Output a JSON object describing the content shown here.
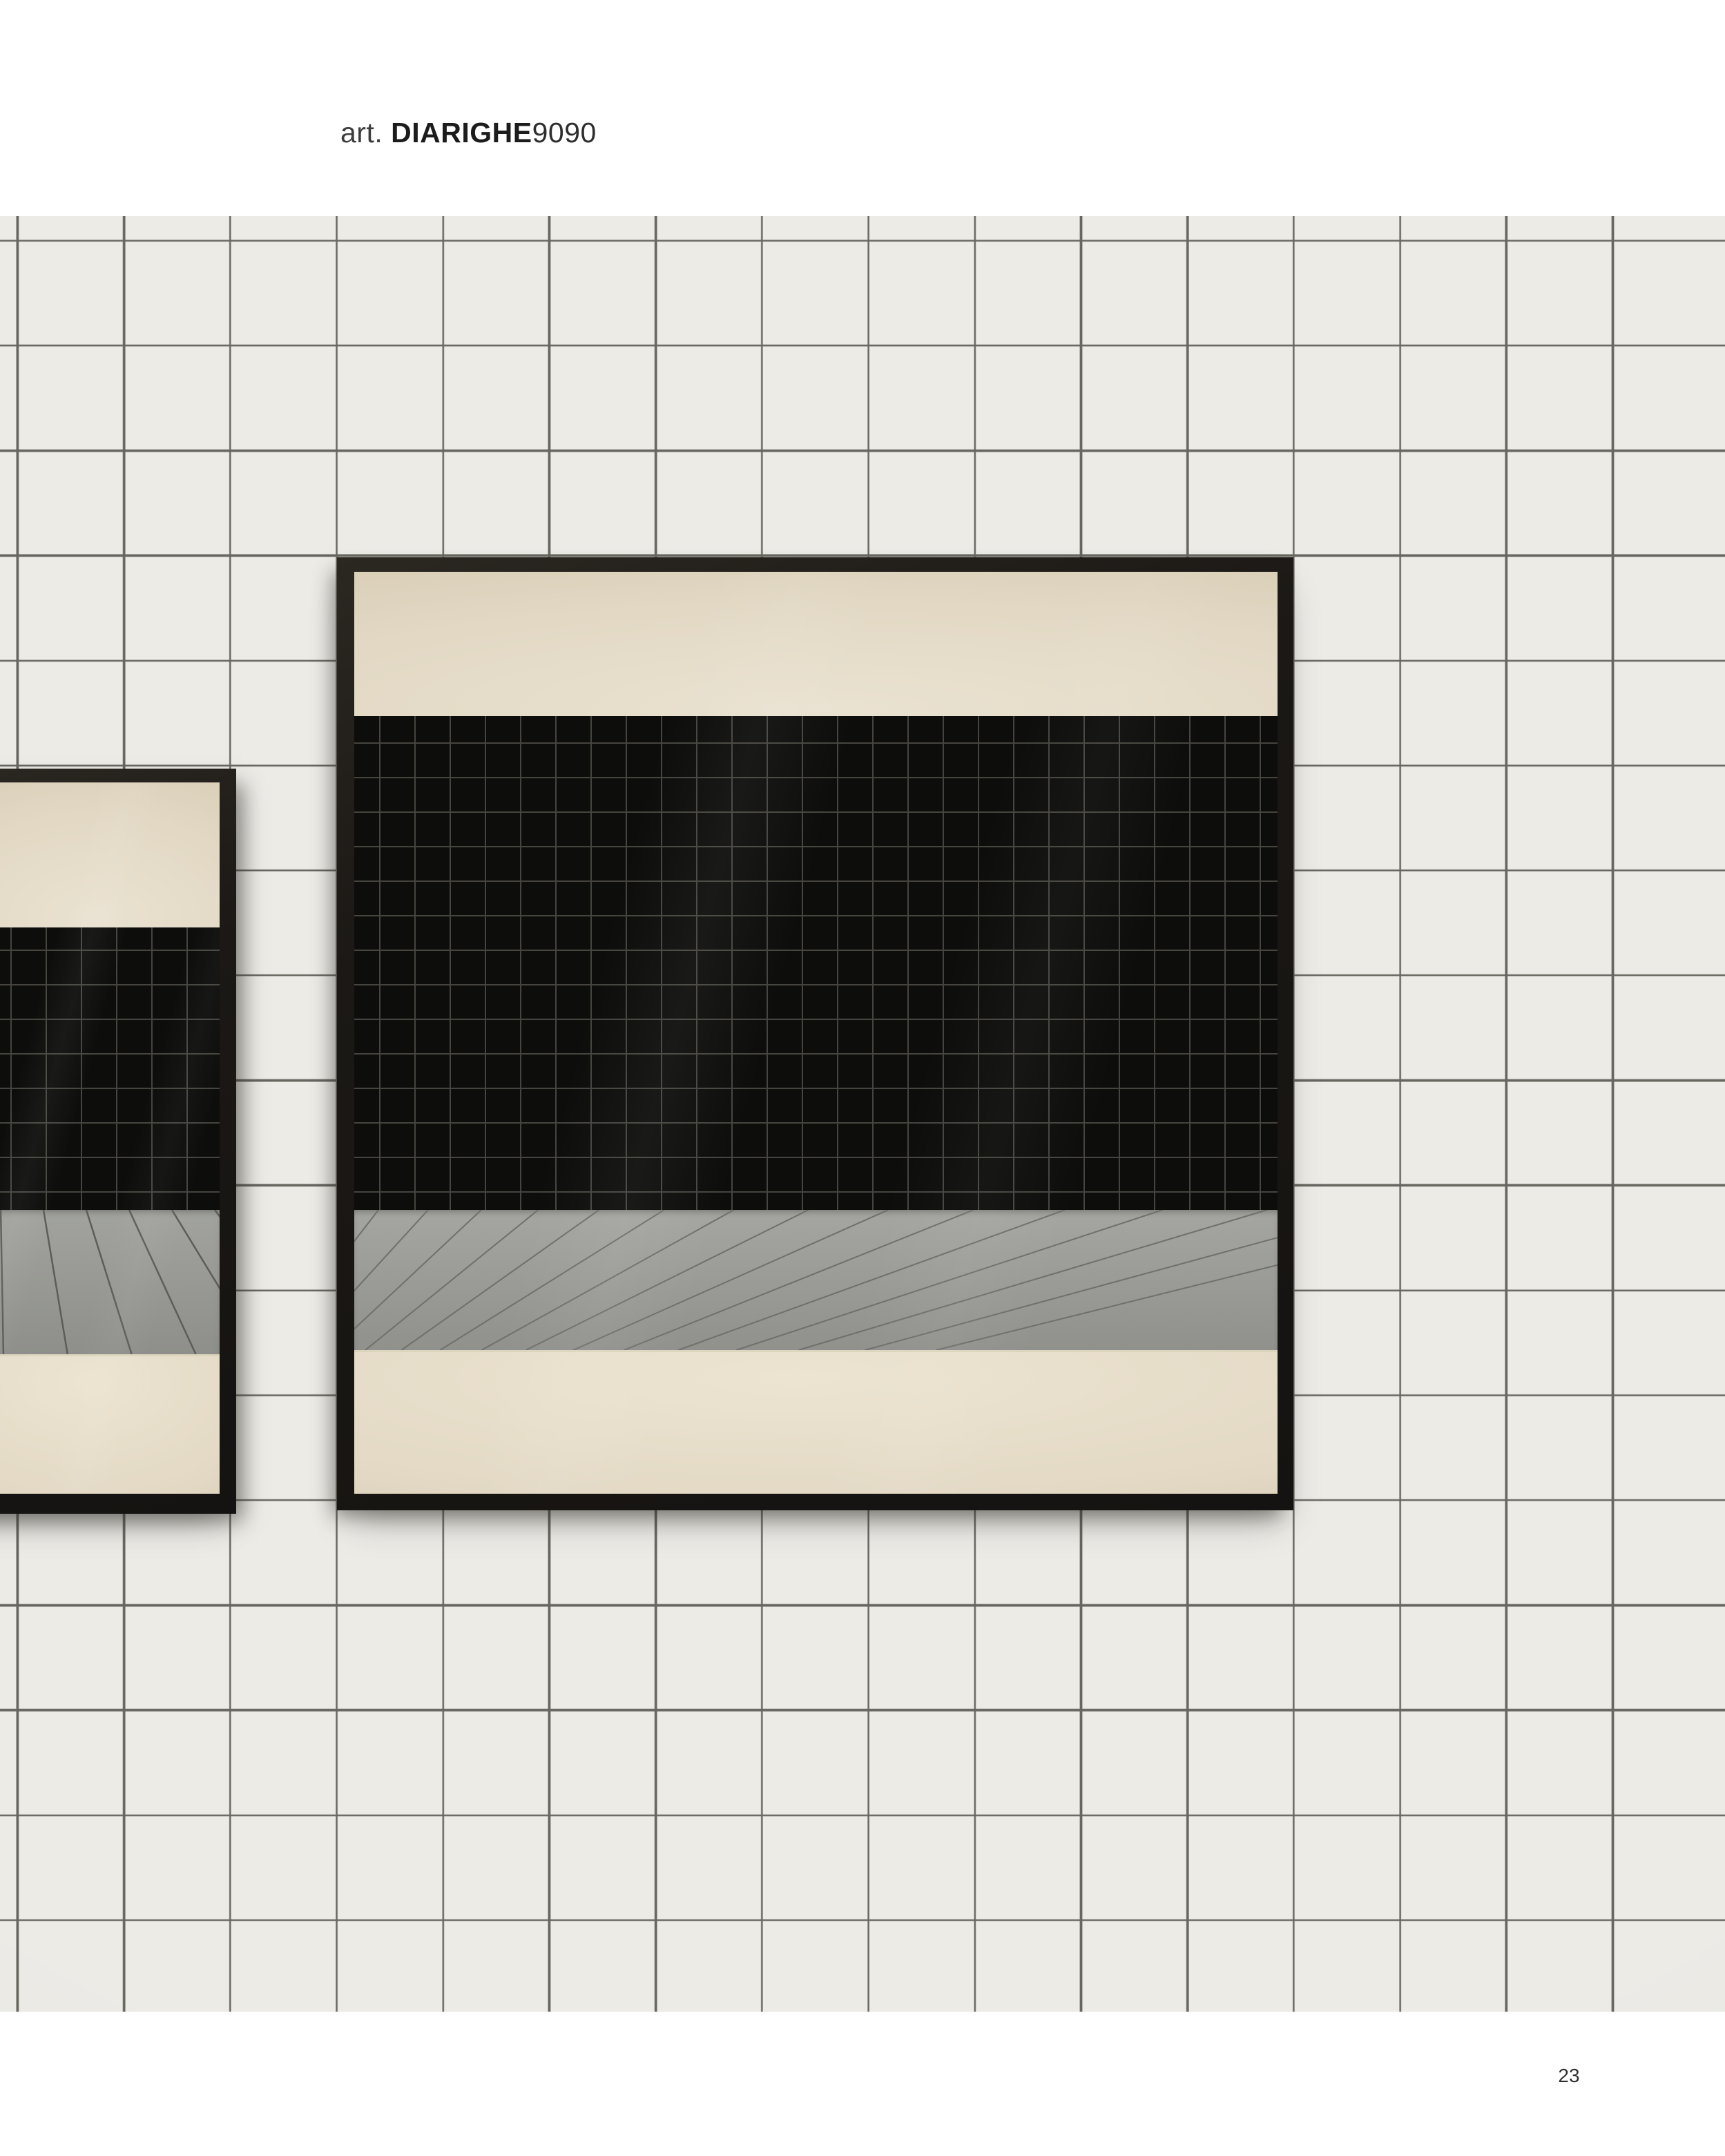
{
  "header": {
    "article_prefix": "art. ",
    "article_name": "DIARIGHE",
    "article_number": "9090"
  },
  "footer": {
    "page_number": "23"
  },
  "colors": {
    "page_background": "#ffffff",
    "wall_tile": "#ecebe6",
    "wall_grout": "#67665f",
    "mirror_frame": "#1b1815",
    "reflection_cream_top": "#e2d8c4",
    "reflection_black_tile": "#0d0d0b",
    "reflection_black_grout": "#45443e",
    "reflection_floor": "#9b9c97",
    "reflection_floor_line": "#6f706b",
    "reflection_cream_bottom": "#e3d9c5",
    "text_dark": "#1c1c1c",
    "text_gray": "#3c3c3c"
  },
  "scene": {
    "description": "Catalog page: two square black-framed mirrors hung on a white square-tiled wall; the mirrors reflect a cream wall band, a black mosaic-tiled wall, a gray diagonal plank floor and a cream lower wall.",
    "mirrors": [
      {
        "name": "small-mirror-cropped-left"
      },
      {
        "name": "large-mirror-center"
      }
    ]
  }
}
